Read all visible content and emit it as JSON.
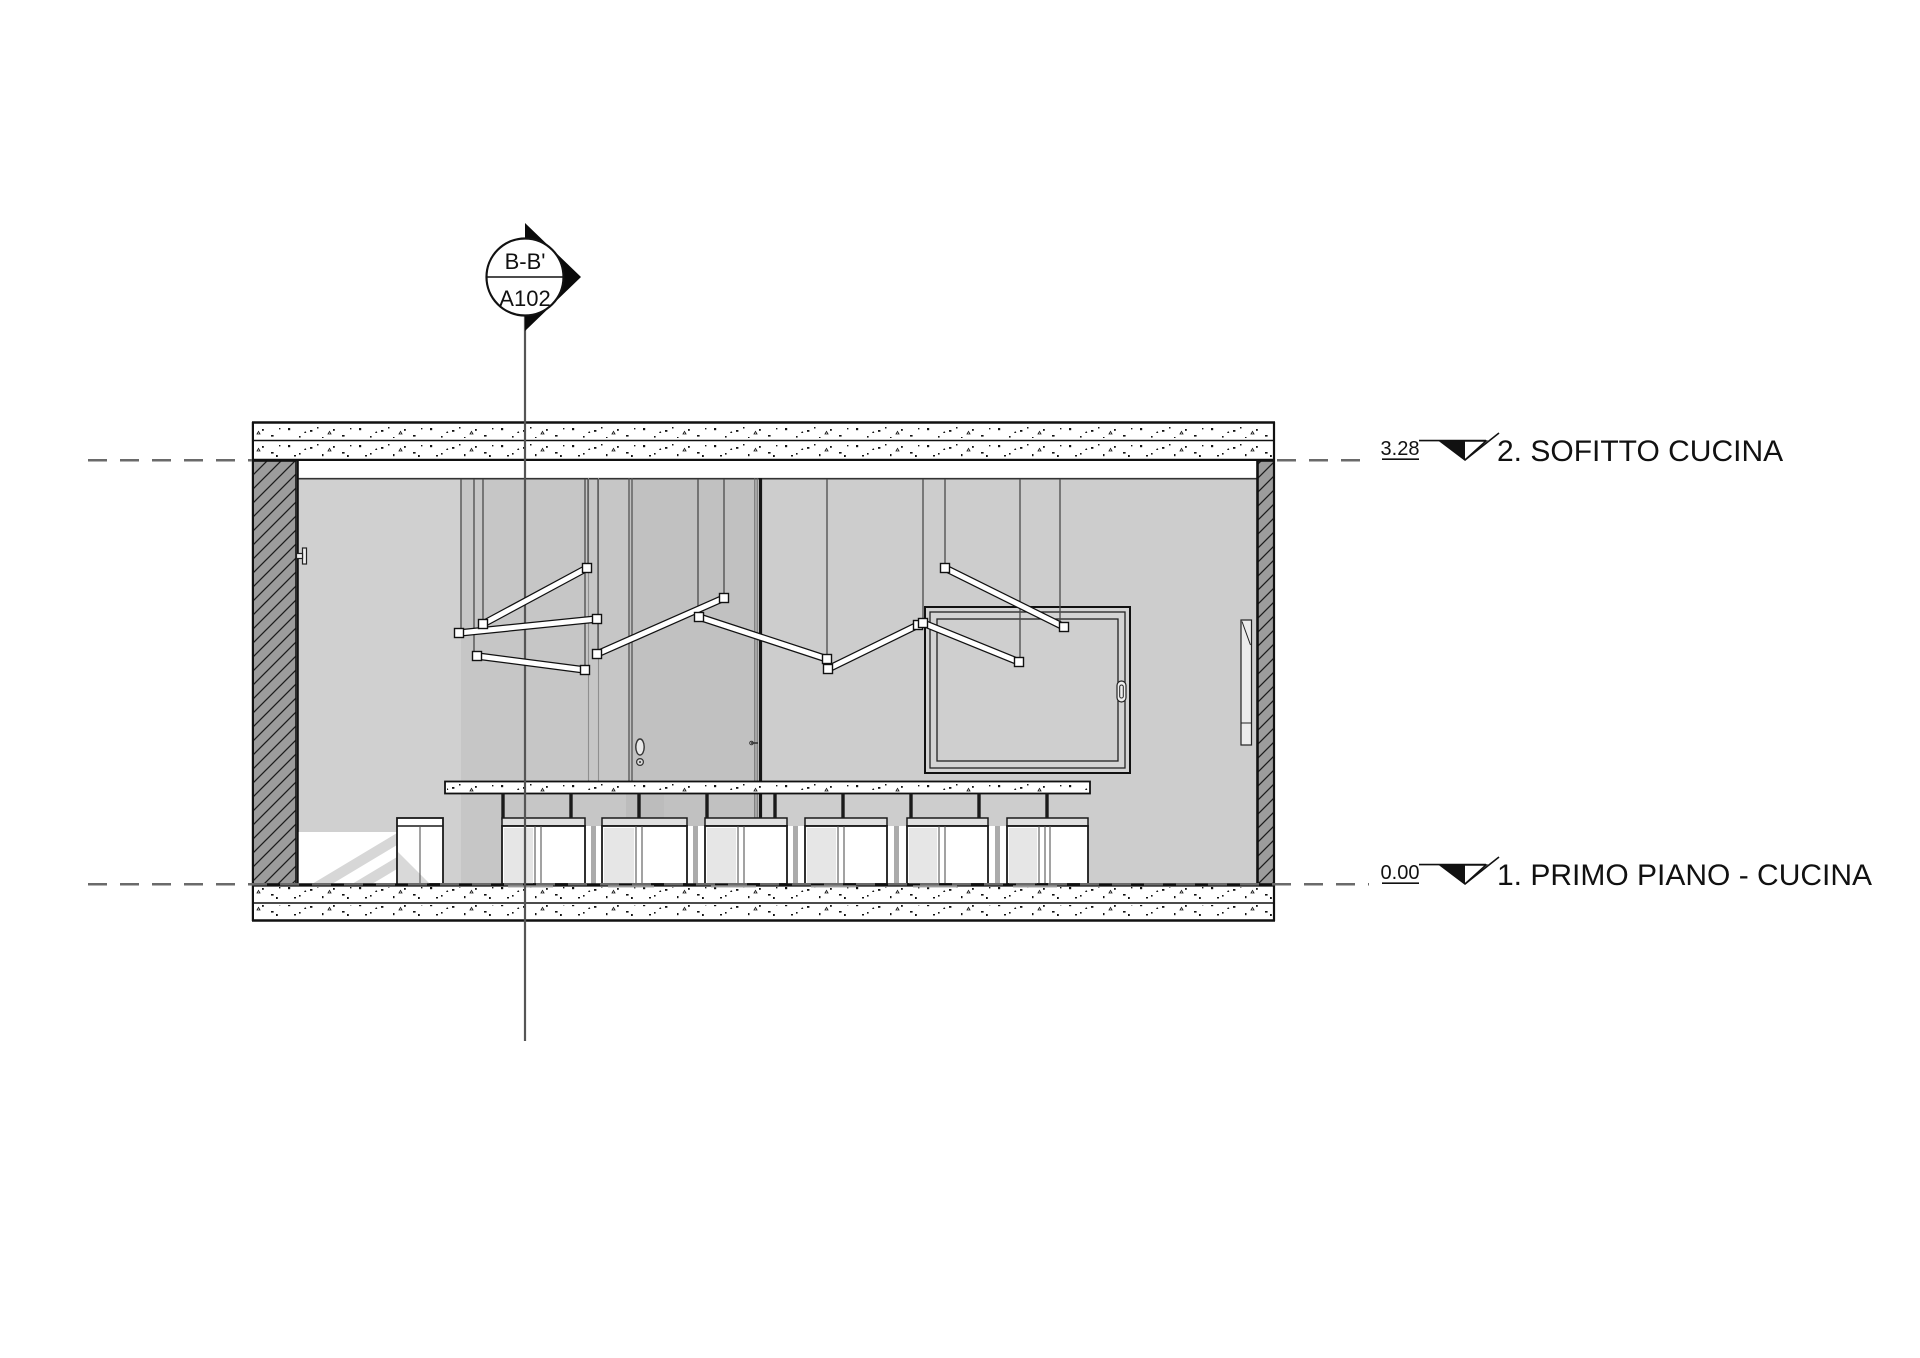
{
  "section_marker": {
    "detail_number": "B-B'",
    "sheet_number": "A102"
  },
  "levels": [
    {
      "elevation": "3.28",
      "name": "2. SOFITTO CUCINA"
    },
    {
      "elevation": "0.00",
      "name": "1. PRIMO PIANO - CUCINA"
    }
  ],
  "colors": {
    "line": "#111111",
    "dashed_level_line": "#6a6a6a",
    "section_line": "#555555",
    "cut_wall_fill": "#9c9c9c",
    "interior_wall_fill": "#cbcbcb",
    "door_fill": "#c1c1c1",
    "background": "#ffffff"
  }
}
